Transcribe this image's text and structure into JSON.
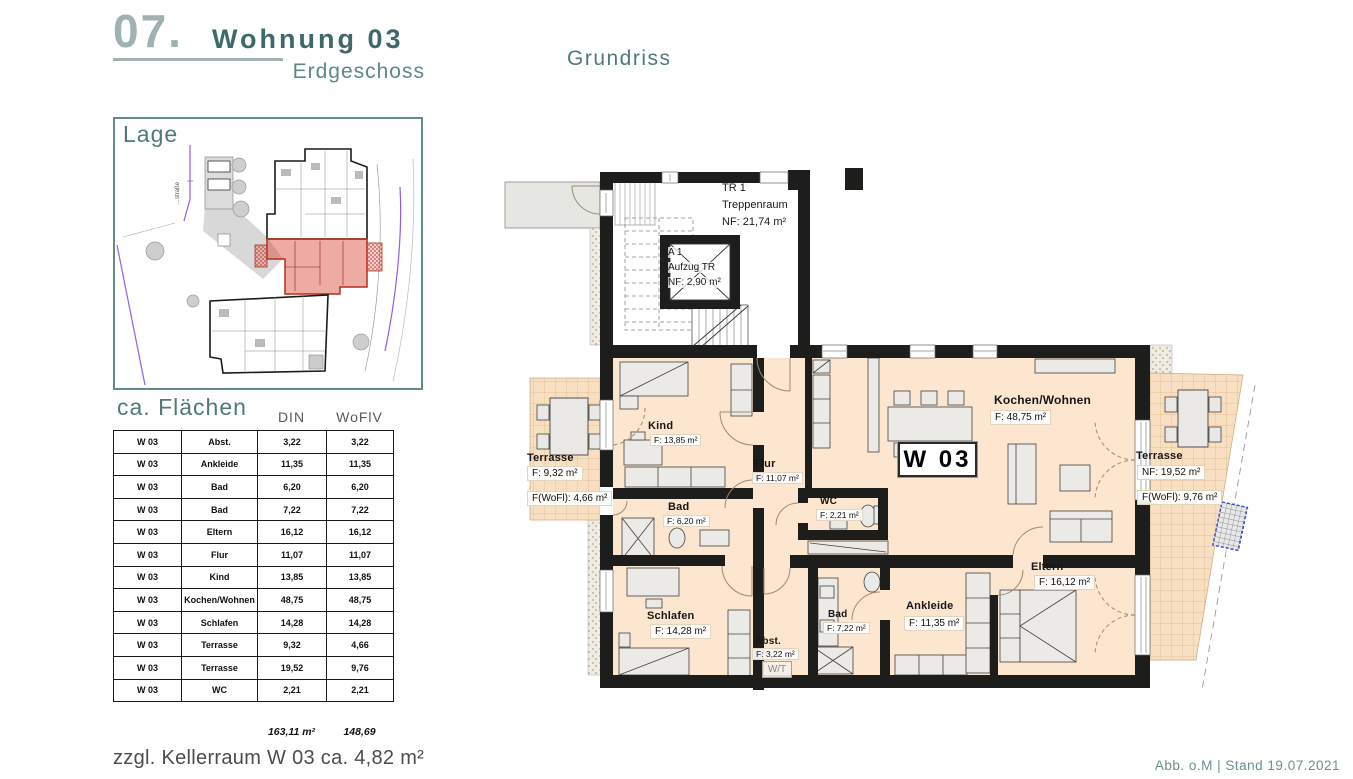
{
  "page": {
    "header": {
      "number": "07.",
      "title": "Wohnung 03",
      "subtitle": "Erdgeschoss"
    },
    "plan_title": "Grundriss",
    "keller_note": "zzgl. Kellerraum W 03  ca. 4,82 m²",
    "footer": "Abb. o.M | Stand 19.07.2021"
  },
  "lage": {
    "title": "Lage",
    "street_label": "…straße"
  },
  "flaechen": {
    "title": "ca. Flächen",
    "col_din": "DIN",
    "col_woflv": "WoFlV",
    "rows": [
      {
        "unit": "W 03",
        "room": "Abst.",
        "din": "3,22",
        "woflv": "3,22"
      },
      {
        "unit": "W 03",
        "room": "Ankleide",
        "din": "11,35",
        "woflv": "11,35"
      },
      {
        "unit": "W 03",
        "room": "Bad",
        "din": "6,20",
        "woflv": "6,20"
      },
      {
        "unit": "W 03",
        "room": "Bad",
        "din": "7,22",
        "woflv": "7,22"
      },
      {
        "unit": "W 03",
        "room": "Eltern",
        "din": "16,12",
        "woflv": "16,12"
      },
      {
        "unit": "W 03",
        "room": "Flur",
        "din": "11,07",
        "woflv": "11,07"
      },
      {
        "unit": "W 03",
        "room": "Kind",
        "din": "13,85",
        "woflv": "13,85"
      },
      {
        "unit": "W 03",
        "room": "Kochen/Wohnen",
        "din": "48,75",
        "woflv": "48,75"
      },
      {
        "unit": "W 03",
        "room": "Schlafen",
        "din": "14,28",
        "woflv": "14,28"
      },
      {
        "unit": "W 03",
        "room": "Terrasse",
        "din": "9,32",
        "woflv": "4,66"
      },
      {
        "unit": "W 03",
        "room": "Terrasse",
        "din": "19,52",
        "woflv": "9,76"
      },
      {
        "unit": "W 03",
        "room": "WC",
        "din": "2,21",
        "woflv": "2,21"
      }
    ],
    "sum_din": "163,11 m²",
    "sum_woflv": "148,69"
  },
  "plan": {
    "treppenraum": {
      "l1": "TR 1",
      "l2": "Treppenraum",
      "l3": "NF:  21,74 m²"
    },
    "aufzug": {
      "l1": "A 1",
      "l2": "Aufzug TR",
      "l3": "NF:  2,90 m²"
    },
    "badge": "W 03",
    "rooms": {
      "kind": {
        "name": "Kind",
        "area": "F: 13,85 m²"
      },
      "flur": {
        "name": "Flur",
        "area": "F: 11,07 m²"
      },
      "bad1": {
        "name": "Bad",
        "area": "F: 6,20 m²"
      },
      "wc": {
        "name": "WC",
        "area": "F: 2,21 m²"
      },
      "kochen": {
        "name": "Kochen/Wohnen",
        "area": "F: 48,75 m²"
      },
      "schlafen": {
        "name": "Schlafen",
        "area": "F: 14,28 m²"
      },
      "abst": {
        "name": "Abst.",
        "area": "F: 3,22 m²",
        "wt": "W/T"
      },
      "bad2": {
        "name": "Bad",
        "area": "F: 7,22 m²"
      },
      "ankleide": {
        "name": "Ankleide",
        "area": "F: 11,35 m²"
      },
      "eltern": {
        "name": "Eltern",
        "area": "F: 16,12 m²"
      },
      "terrasse_l": {
        "name": "Terrasse",
        "area": "F: 9,32 m²",
        "area2": "F(WoFl): 4,66 m²"
      },
      "terrasse_r": {
        "name": "Terrasse",
        "area": "NF: 19,52 m²",
        "area2": "F(WoFl): 9,76 m²"
      }
    }
  },
  "colors": {
    "accent_teal": "#4e7a78",
    "accent_light": "#9fb1b1",
    "wall": "#1d1d1b",
    "floor": "#fce6d0",
    "terrace": "#f8dfc2",
    "highlight_red": "#c0392b",
    "boundary_purple": "#8f5ce8"
  }
}
